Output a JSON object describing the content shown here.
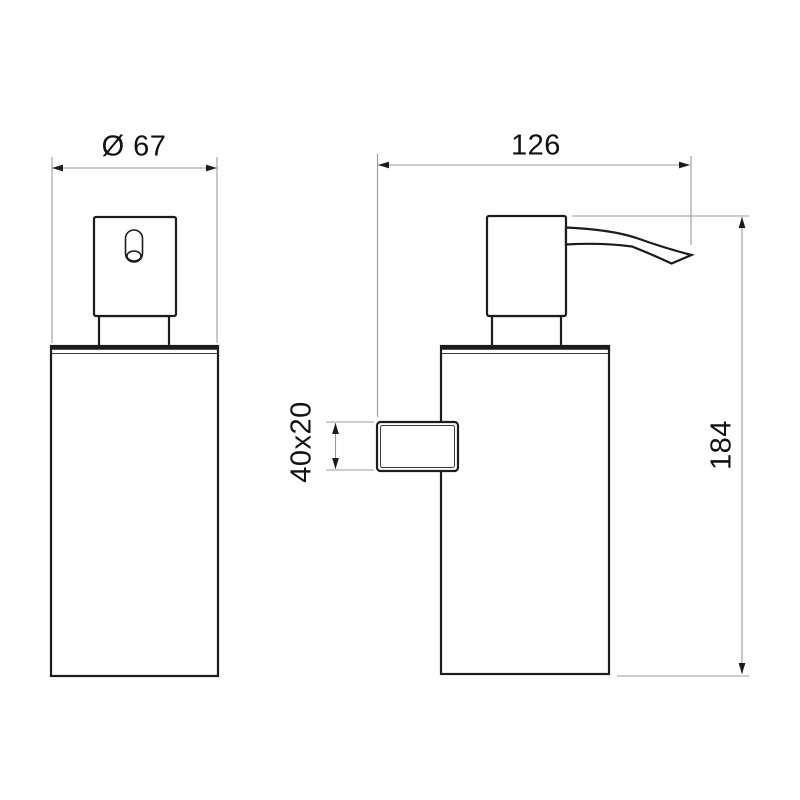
{
  "style": {
    "page_background": "#ffffff",
    "object_line_color": "#1c1c1c",
    "dimension_line_color": "#9a9a9a",
    "text_color": "#111111"
  },
  "drawing": {
    "type": "technical-dimension-drawing",
    "views": [
      {
        "id": "front-view",
        "parts": [
          "pump-head",
          "outlet-slot",
          "neck",
          "lid",
          "body"
        ]
      },
      {
        "id": "side-view",
        "parts": [
          "pump-head",
          "spout",
          "neck",
          "lid",
          "body",
          "wall-bracket"
        ]
      }
    ],
    "dimensions": {
      "diameter_label": "Ø 67",
      "depth_label": "126",
      "height_label": "184",
      "bracket_label": "40x20"
    }
  }
}
